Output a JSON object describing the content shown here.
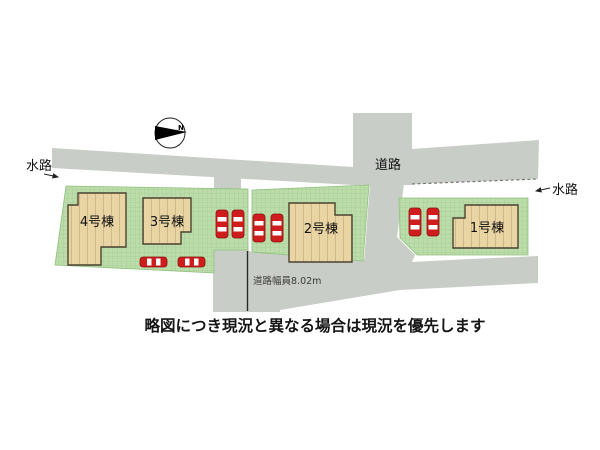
{
  "plan": {
    "compass_label": "N",
    "labels": {
      "waterway_left": "水路",
      "road": "道路",
      "waterway_right": "水路",
      "road_width": "道路幅員8.02m"
    },
    "buildings": [
      {
        "label": "1号棟"
      },
      {
        "label": "2号棟"
      },
      {
        "label": "3号棟"
      },
      {
        "label": "4号棟"
      }
    ],
    "note": "略図につき現況と異なる場合は現況を優先します",
    "colors": {
      "lot_green": "#bcdcaa",
      "lot_grid": "#90c07e",
      "road_gray": "#c9cdc7",
      "building_beige": "#e9d4a4",
      "building_outline": "#4a4331",
      "car_red": "#cf1d1d",
      "car_window": "#ffffff"
    }
  }
}
